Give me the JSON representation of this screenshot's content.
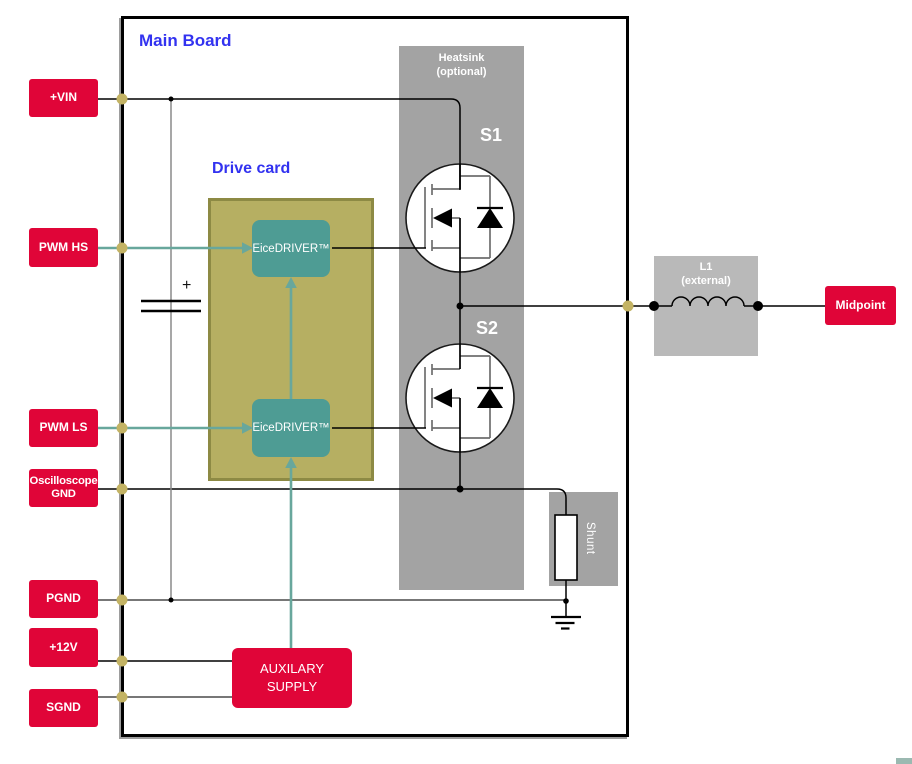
{
  "board": {
    "title": "Main Board"
  },
  "drive_card": {
    "title": "Drive card",
    "driver_hs": "EiceDRIVER™",
    "driver_ls": "EiceDRIVER™"
  },
  "heatsink": {
    "name": "Heatsink",
    "note": "(optional)"
  },
  "switches": {
    "s1": "S1",
    "s2": "S2"
  },
  "shunt": {
    "label": "Shunt"
  },
  "inductor": {
    "name": "L1",
    "note": "(external)"
  },
  "aux_supply": {
    "line1": "AUXILARY",
    "line2": "SUPPLY"
  },
  "capacitor": {
    "polarity": "+"
  },
  "terminals": {
    "vin": "+VIN",
    "pwm_hs": "PWM HS",
    "pwm_ls": "PWM LS",
    "osc_gnd": "Oscilloscope GND",
    "pgnd": "PGND",
    "p12v": "+12V",
    "sgnd": "SGND",
    "midpoint": "Midpoint"
  },
  "colors": {
    "terminal_red": "#e00538",
    "title_blue": "#3232f0",
    "driver_teal": "#4e9c94",
    "signal_teal": "#68a79c",
    "card_olive": "#b6af62",
    "card_border_olive": "#8d8a44",
    "heatsink_gray": "#a3a3a3",
    "inductor_gray": "#b9b9b9",
    "node_olive": "#c3b364",
    "wire_black": "#000000"
  }
}
